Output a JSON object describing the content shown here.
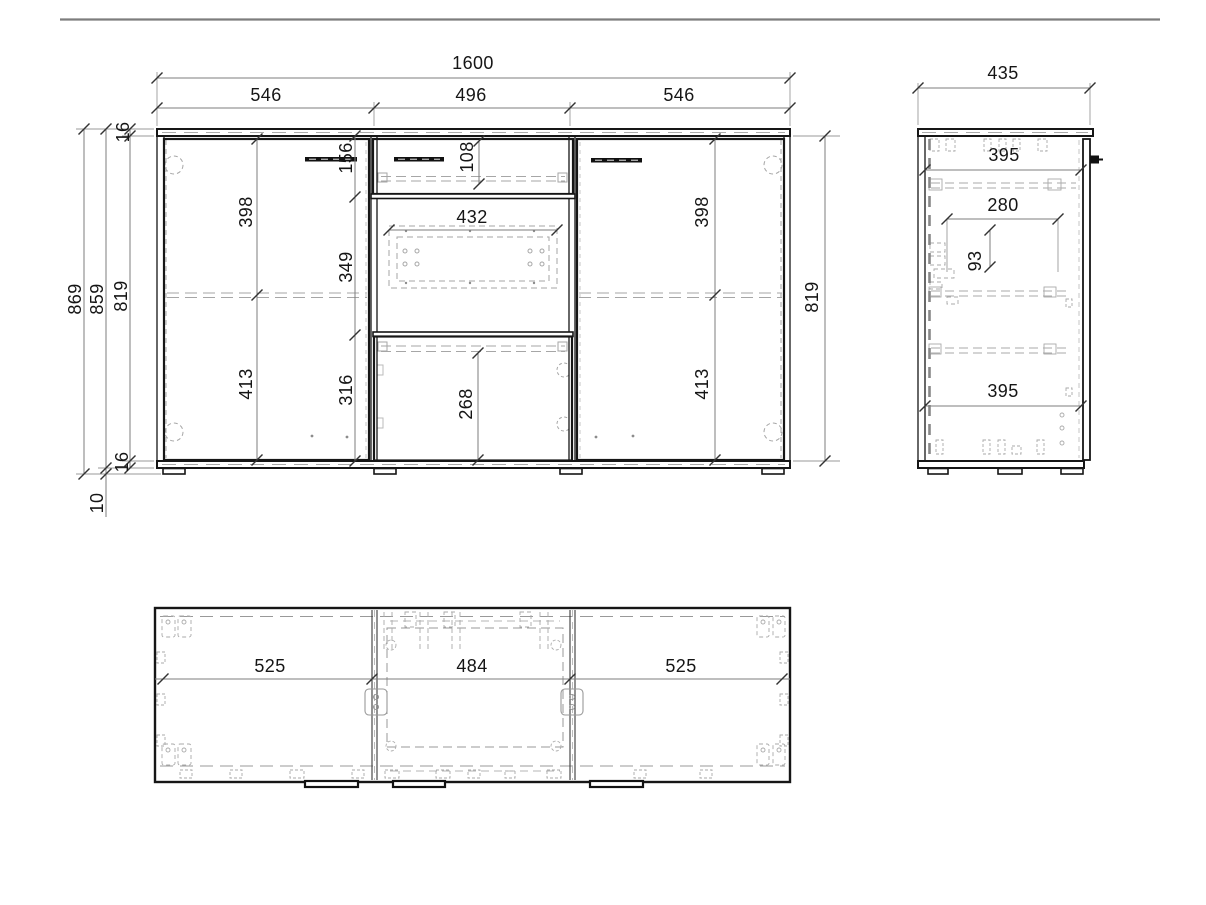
{
  "drawing_title": "sideboard-technical-drawing",
  "front": {
    "total_width": "1600",
    "left_door_width": "546",
    "center_width": "496",
    "right_door_width": "546",
    "total_height": "869",
    "body_height": "859",
    "interior_height_left": "819",
    "interior_height_right": "819",
    "top_panel_thickness": "16",
    "bottom_panel_thickness": "16",
    "foot_height": "10",
    "left_door_upper": "398",
    "left_door_lower": "413",
    "right_door_upper": "398",
    "right_door_lower": "413",
    "drawer_zone_height": "156",
    "drawer_opening_height": "108",
    "niche_width": "432",
    "niche_height": "349",
    "lower_zone_height": "316",
    "lower_opening_height": "268"
  },
  "side": {
    "depth": "435",
    "upper_opening_depth": "395",
    "drawer_depth": "280",
    "clearance": "93",
    "lower_opening_depth": "395"
  },
  "top": {
    "left_section_width": "525",
    "center_section_width": "484",
    "right_section_width": "525"
  }
}
